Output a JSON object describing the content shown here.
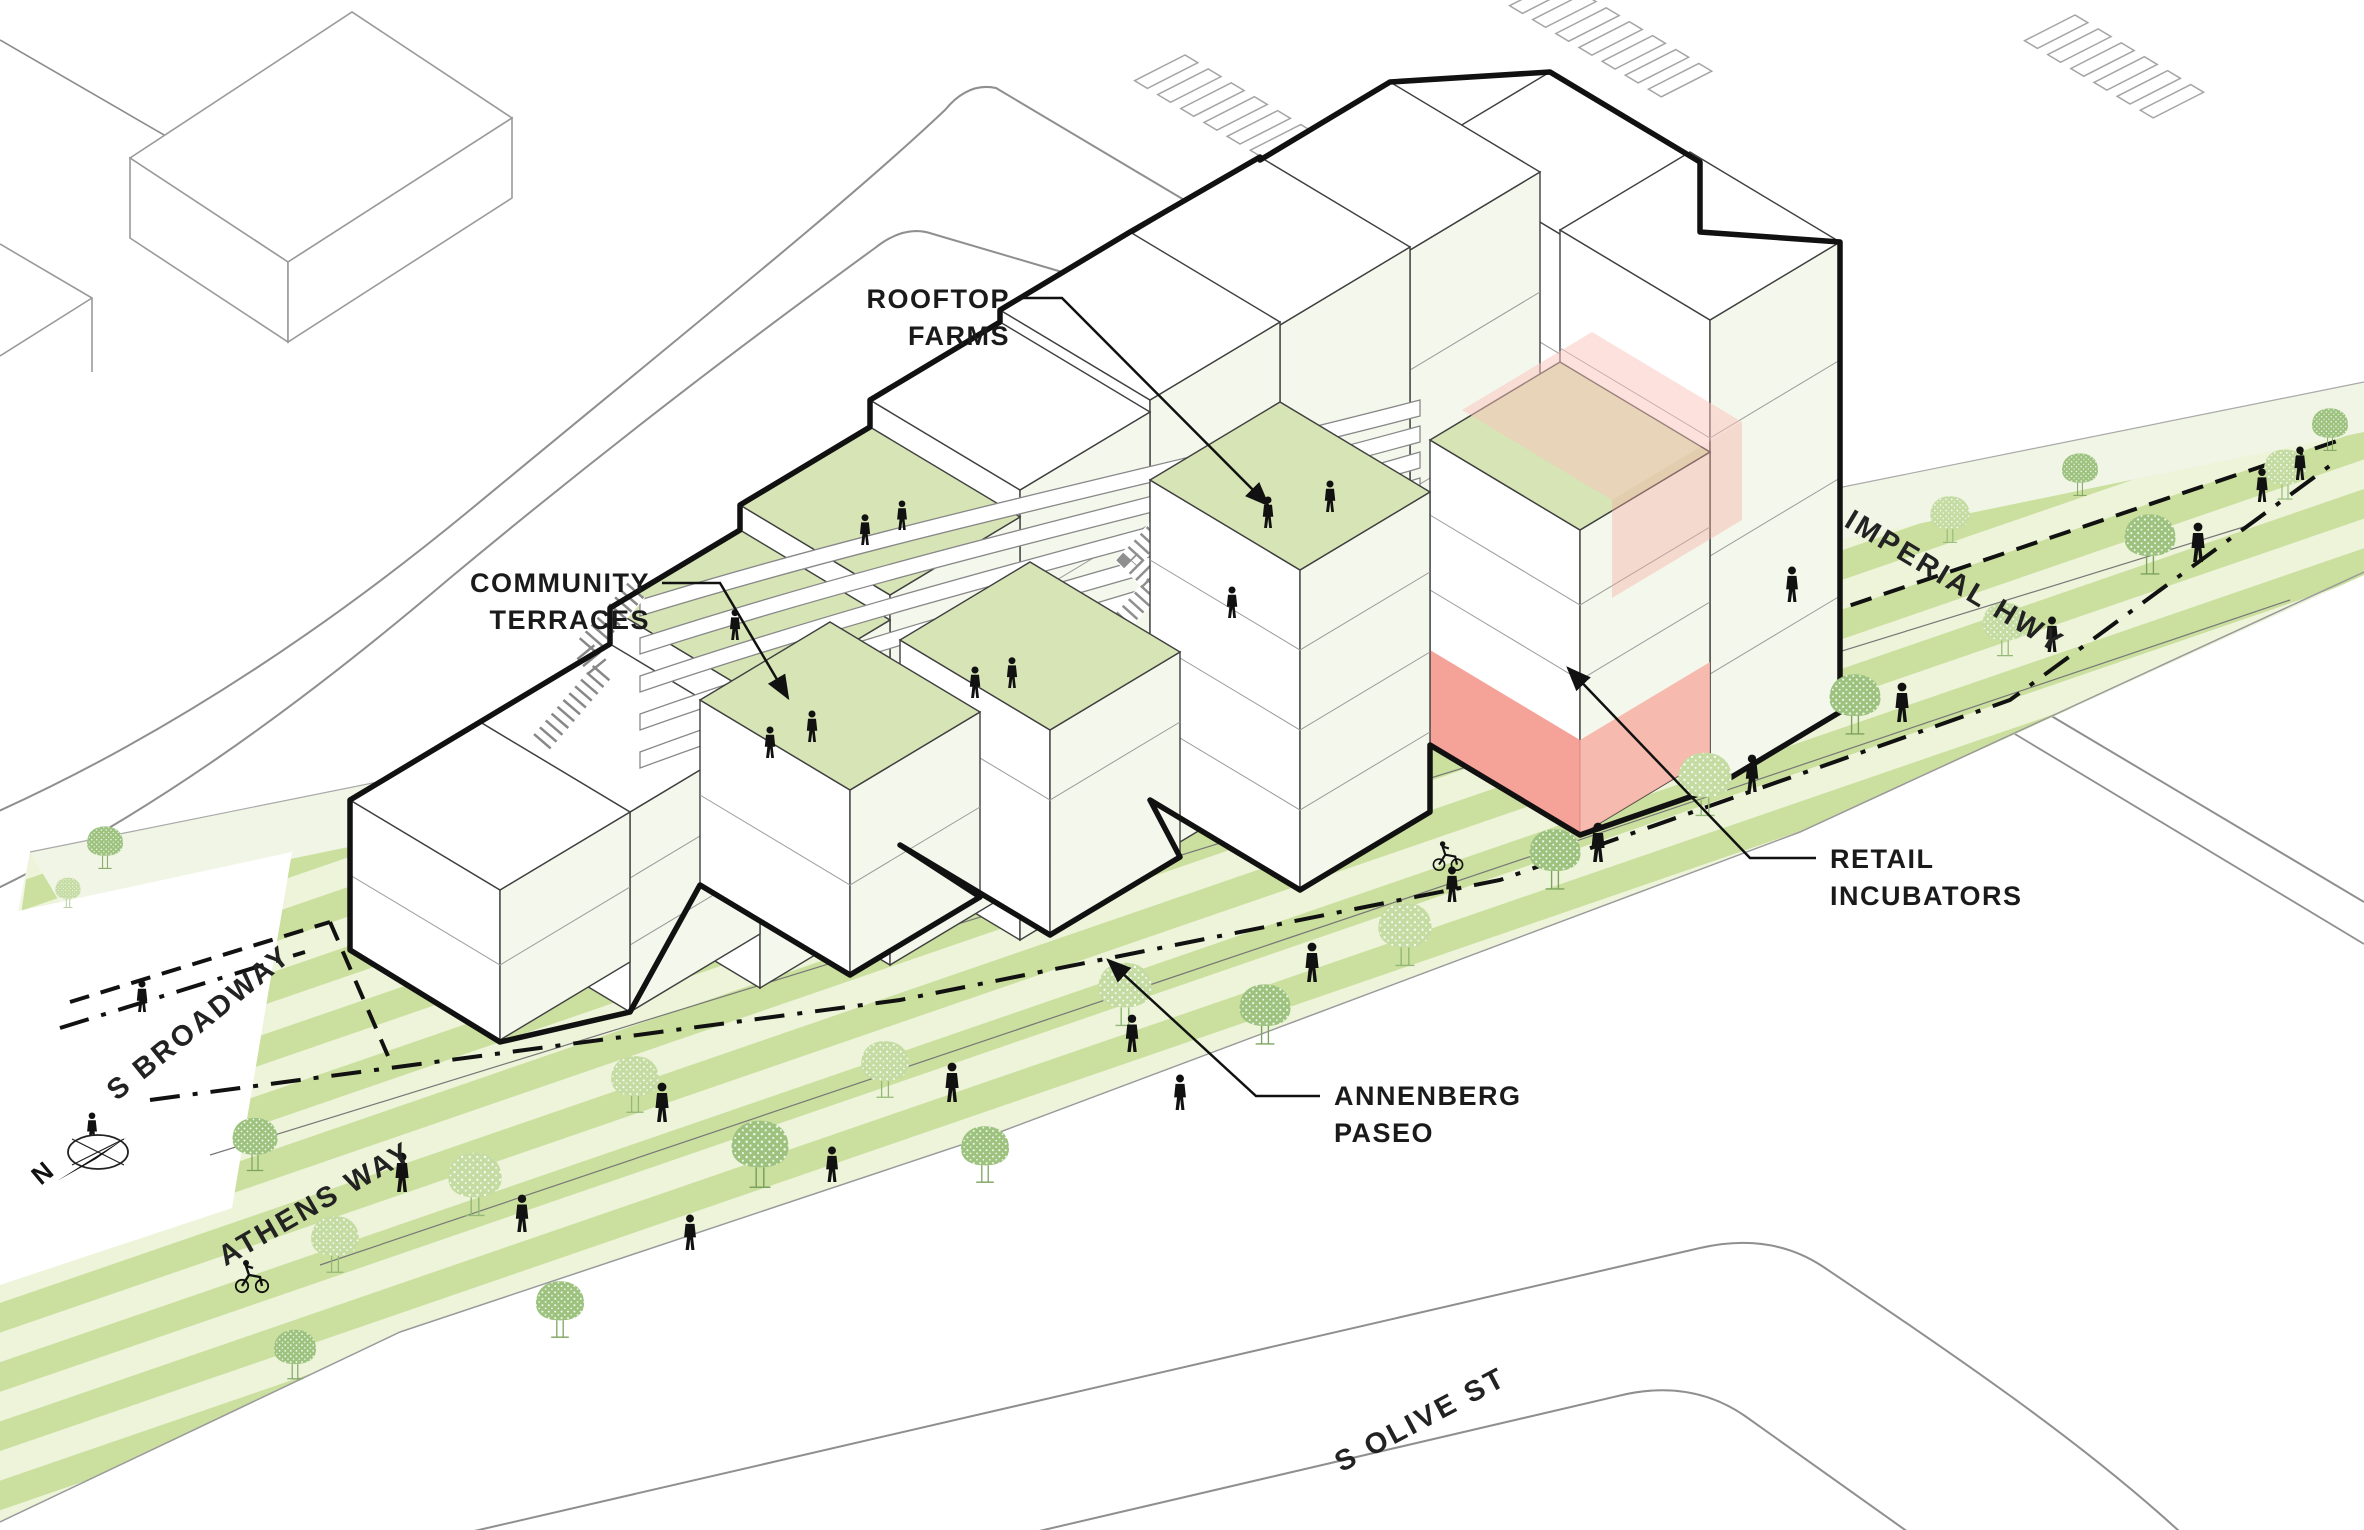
{
  "diagram": {
    "type": "axonometric-site-diagram",
    "annotations": {
      "rooftop_farms": {
        "line1": "ROOFTOP",
        "line2": "FARMS"
      },
      "community_terraces": {
        "line1": "COMMUNITY",
        "line2": "TERRACES"
      },
      "retail_incubators": {
        "line1": "RETAIL",
        "line2": "INCUBATORS"
      },
      "annenberg_paseo": {
        "line1": "ANNENBERG",
        "line2": "PASEO"
      }
    },
    "streets": {
      "s_broadway": "S BROADWAY",
      "athens_way": "ATHENS WAY",
      "imperial_hwy": "IMPERIAL HWY",
      "s_olive_st": "S OLIVE ST"
    },
    "compass": {
      "north_label": "N"
    },
    "colors": {
      "paseo_stripe_dark": "#cbdf9e",
      "paseo_stripe_light": "#edf4da",
      "rooftop_green": "#d6e4b6",
      "retail_pink": "#f4988e",
      "tree_green": "#9cc27e",
      "outline_black": "#111111"
    }
  }
}
